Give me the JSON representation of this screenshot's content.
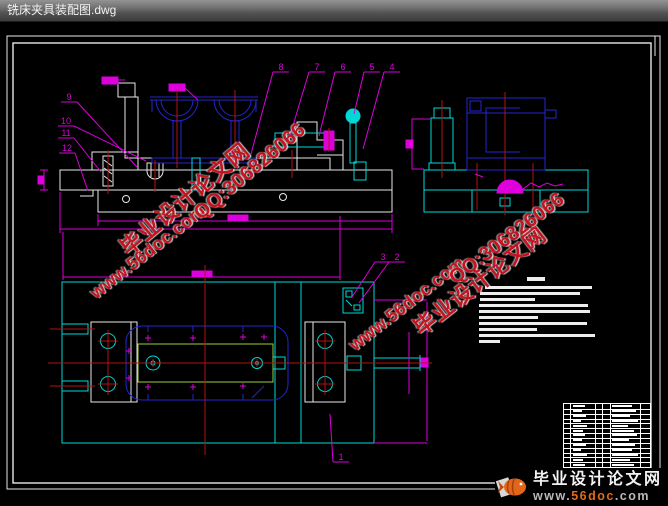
{
  "window": {
    "title": "铣床夹具装配图.dwg"
  },
  "watermark": {
    "site": "毕业设计论文网",
    "qq": "QQ:306826066",
    "url": "www.56doc.com"
  },
  "logo": {
    "site": "毕业设计论文网",
    "url_www": "www.",
    "url_name": "56doc",
    "url_tld": ".com"
  },
  "colors": {
    "line_white": "#e8e8e8",
    "line_cyan": "#00d8d8",
    "line_blue": "#2424cf",
    "line_magenta": "#dd00dd",
    "line_red": "#b31212",
    "line_green": "#9acd32",
    "watermark_red": "#c41420",
    "logo_orange": "#e06a1a",
    "background": "#000000"
  },
  "callouts": [
    {
      "n": "9",
      "x": 69,
      "y": 97,
      "tx": 137,
      "ty": 167
    },
    {
      "n": "10",
      "x": 66,
      "y": 121,
      "tx": 146,
      "ty": 161
    },
    {
      "n": "11",
      "x": 66,
      "y": 133,
      "tx": 101,
      "ty": 172
    },
    {
      "n": "12",
      "x": 67,
      "y": 148,
      "tx": 88,
      "ty": 191
    },
    {
      "n": "8",
      "x": 281,
      "y": 67,
      "tx": 251,
      "ty": 154
    },
    {
      "n": "7",
      "x": 317,
      "y": 67,
      "tx": 286,
      "ty": 149
    },
    {
      "n": "6",
      "x": 343,
      "y": 67,
      "tx": 319,
      "ty": 136
    },
    {
      "n": "5",
      "x": 372,
      "y": 67,
      "tx": 354,
      "ty": 114
    },
    {
      "n": "4",
      "x": 392,
      "y": 67,
      "tx": 363,
      "ty": 149
    },
    {
      "n": "3",
      "x": 383,
      "y": 257,
      "tx": 352,
      "ty": 297
    },
    {
      "n": "2",
      "x": 397,
      "y": 257,
      "tx": 359,
      "ty": 303
    },
    {
      "n": "1",
      "x": 341,
      "y": 457,
      "tx": 330,
      "ty": 414
    }
  ],
  "tech_requirements": {
    "bars": [
      [
        527,
        277,
        18,
        4
      ],
      [
        485,
        286,
        107,
        3
      ],
      [
        480,
        292,
        100,
        3
      ],
      [
        480,
        298,
        55,
        3
      ],
      [
        479,
        304,
        109,
        3
      ],
      [
        479,
        310,
        111,
        3
      ],
      [
        479,
        316,
        59,
        3
      ],
      [
        479,
        322,
        108,
        3
      ],
      [
        479,
        328,
        58,
        3
      ],
      [
        479,
        334,
        116,
        3
      ],
      [
        479,
        340,
        21,
        3
      ]
    ]
  },
  "parts_table": {
    "x": 563,
    "y": 403,
    "w": 88,
    "h": 68,
    "rows": 14,
    "cols": [
      6,
      31,
      38,
      46,
      76
    ],
    "row_blobs": [
      [
        12,
        20
      ],
      [
        9,
        24
      ],
      [
        13,
        18
      ],
      [
        8,
        26
      ],
      [
        14,
        16
      ],
      [
        10,
        22
      ],
      [
        12,
        25
      ],
      [
        9,
        17
      ],
      [
        13,
        23
      ],
      [
        8,
        20
      ],
      [
        14,
        26
      ],
      [
        10,
        18
      ],
      [
        12,
        22
      ],
      [
        16,
        12
      ]
    ]
  }
}
